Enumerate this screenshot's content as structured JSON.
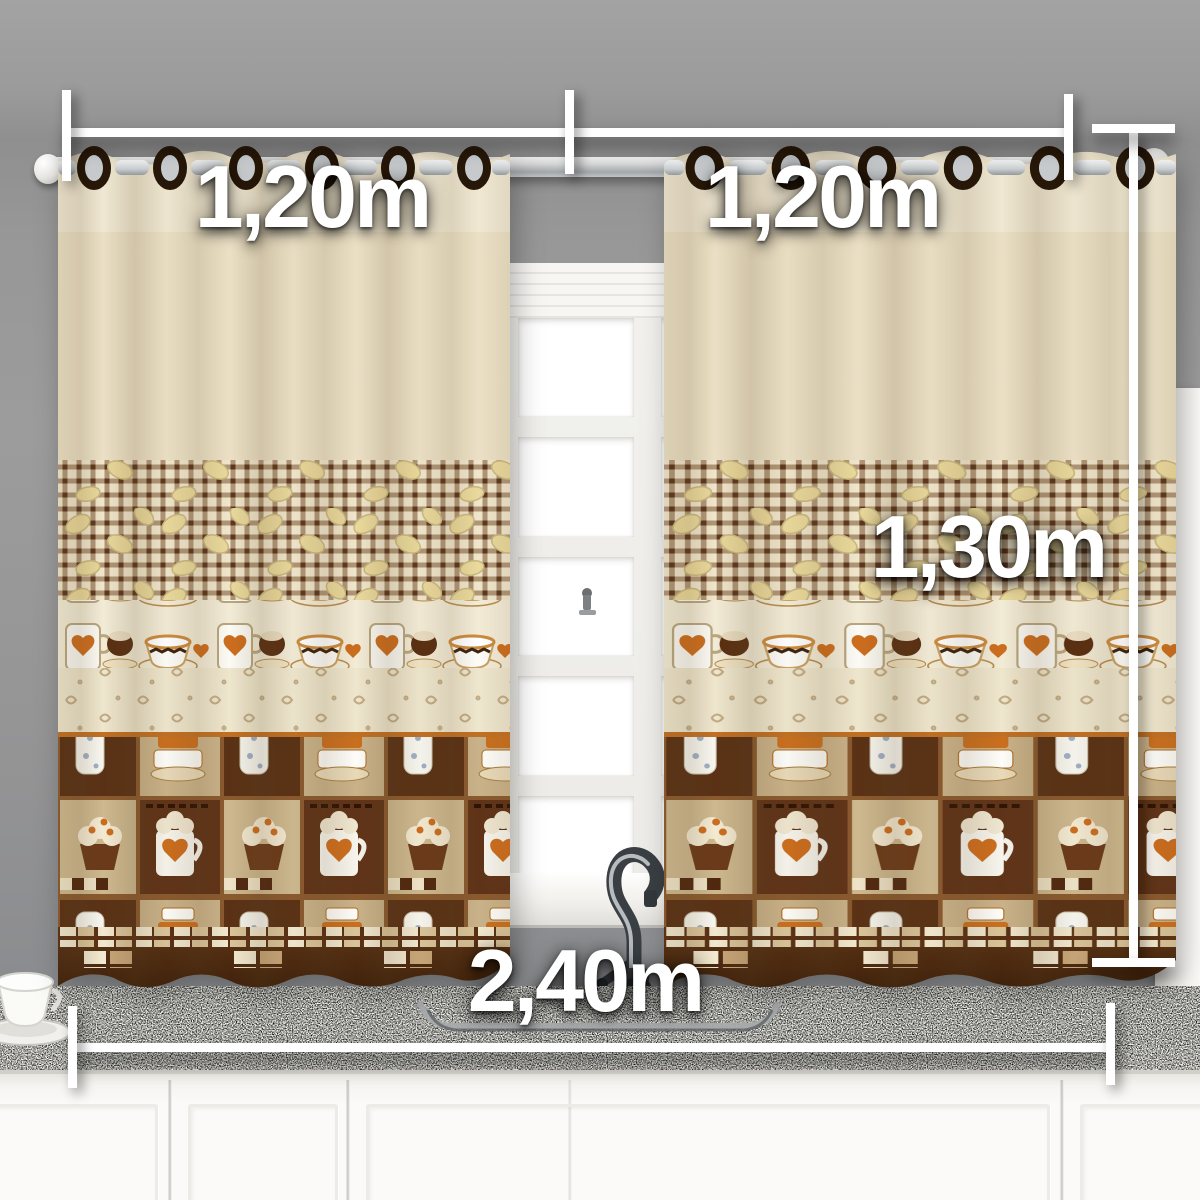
{
  "description": "Product photo of coffee-themed kitchen curtain set on a rod over a window and sink, annotated with dimensions",
  "measurements": {
    "left_panel_width": "1,20m",
    "right_panel_width": "1,20m",
    "panel_height": "1,30m",
    "total_width": "2,40m"
  },
  "colors": {
    "annotation_white": "#ffffff",
    "wall_gray": "#969696",
    "curtain_cream": "#ebe0c5",
    "gingham_brown": "#6b4a2c",
    "hem_brown": "#46250e",
    "accent_orange": "#c96f1f",
    "granite_gray": "#5b5853",
    "cabinet_white": "#f8f7f4",
    "rod_silver": "#c9ccce"
  }
}
